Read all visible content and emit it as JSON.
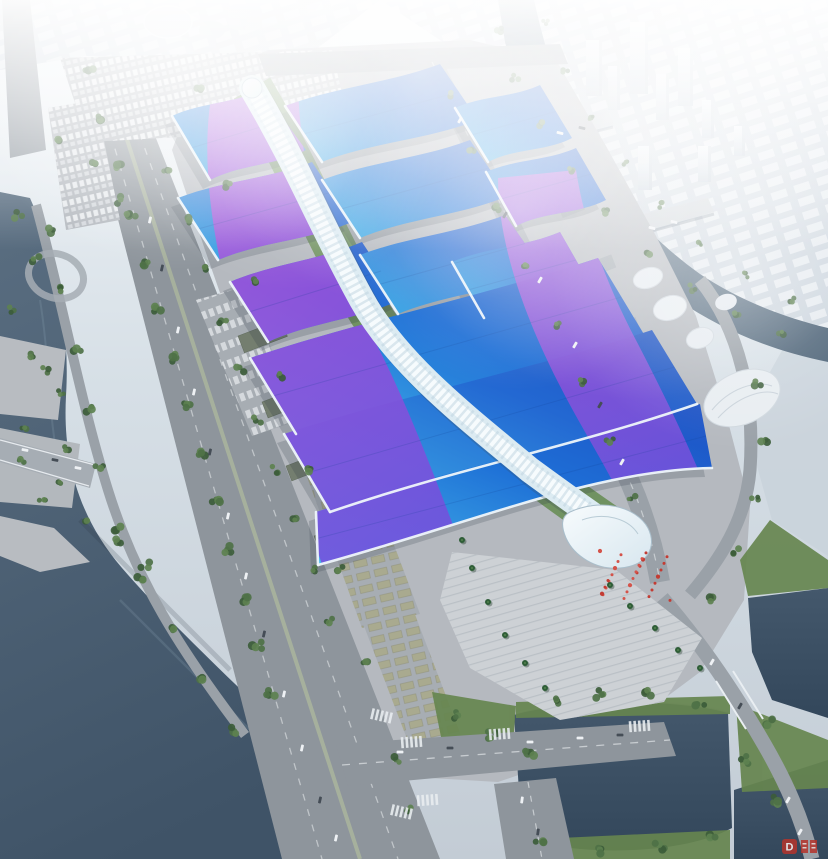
{
  "meta": {
    "title": "Aerial rendering of a riverside exhibition and convention center",
    "type": "architectural-bird's-eye-rendering"
  },
  "scene": {
    "description": "Bird's-eye architectural rendering of a large exhibition complex: paired wavy roofs in cyan-blue with sweeping magenta-violet ribbons flank a white serpentine central walkway that ends in a wave-shaped entrance canopy beside a stepped plaza with red crowd markers and palm trees. The site is bordered by a tree-lined boulevard and dark river on the west, a hazy white city and canal with bridges on the northeast, parking lots to the north, and ponds, green banks and a road intersection to the south.",
    "landmarks": [
      "exhibition halls with blue-purple wave roofs",
      "white serpentine spine walkway",
      "entrance plaza with red crowd markers",
      "tree-lined boulevard",
      "rivers and ponds",
      "hazy distant city with towers",
      "canal bridges",
      "parking lots with buses and cars"
    ]
  },
  "watermark": {
    "text": "D",
    "color": "#b5342c"
  },
  "palette": {
    "haze": "#e9eff4",
    "roof_cyan": "#45b9ea",
    "roof_blue": "#1e6fd6",
    "roof_deep": "#1d50c4",
    "ribbon_magenta": "#b84fd8",
    "ribbon_violet": "#7550dc",
    "spine_white": "#e9f3f7",
    "water_dark": "#42566a",
    "water_canal": "#5d7386",
    "ground": "#b5b9bf",
    "road": "#8e959c",
    "tree_green": "#4e7147",
    "plaza_stone": "#cdd1d5",
    "flag_red": "#c23c33"
  }
}
